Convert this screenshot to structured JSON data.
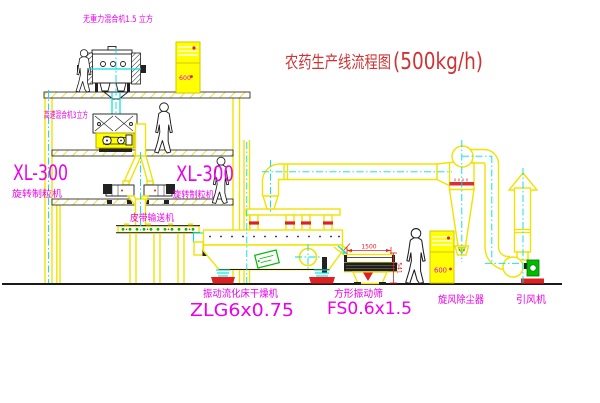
{
  "title": {
    "zh": "农药生产线流程图",
    "capacity": "(500kg/h)"
  },
  "equipment": {
    "gravity_mixer": "无重力混合机1.5 立方",
    "high_speed_mixer": "高速混合机3立方",
    "granulator_left": {
      "model": "XL-300",
      "name": "旋转制粒机"
    },
    "granulator_right": {
      "model": "XL-300",
      "name": "旋转制粒机"
    },
    "belt_conveyor": "皮带输送机",
    "fluid_bed_dryer": {
      "name": "振动流化床干燥机",
      "model": "ZLG6x0.75"
    },
    "square_sieve": {
      "name": "方形振动筛",
      "model": "FS0.6x1.5"
    },
    "cyclone": "旋风除尘器",
    "induced_fan": "引风机"
  },
  "control_cabinets": {
    "upper": "600",
    "lower": "600"
  },
  "dimensions": {
    "sieve_length": "1500",
    "sieve_height": "541"
  },
  "colors": {
    "structure_yellow": "#f0e300",
    "centerline_cyan": "#00dddd",
    "label_magenta": "#ea00ea",
    "title_red": "#cf3333",
    "detail_red": "#e02020",
    "detail_green": "#00bb00",
    "background": "#ffffff"
  }
}
